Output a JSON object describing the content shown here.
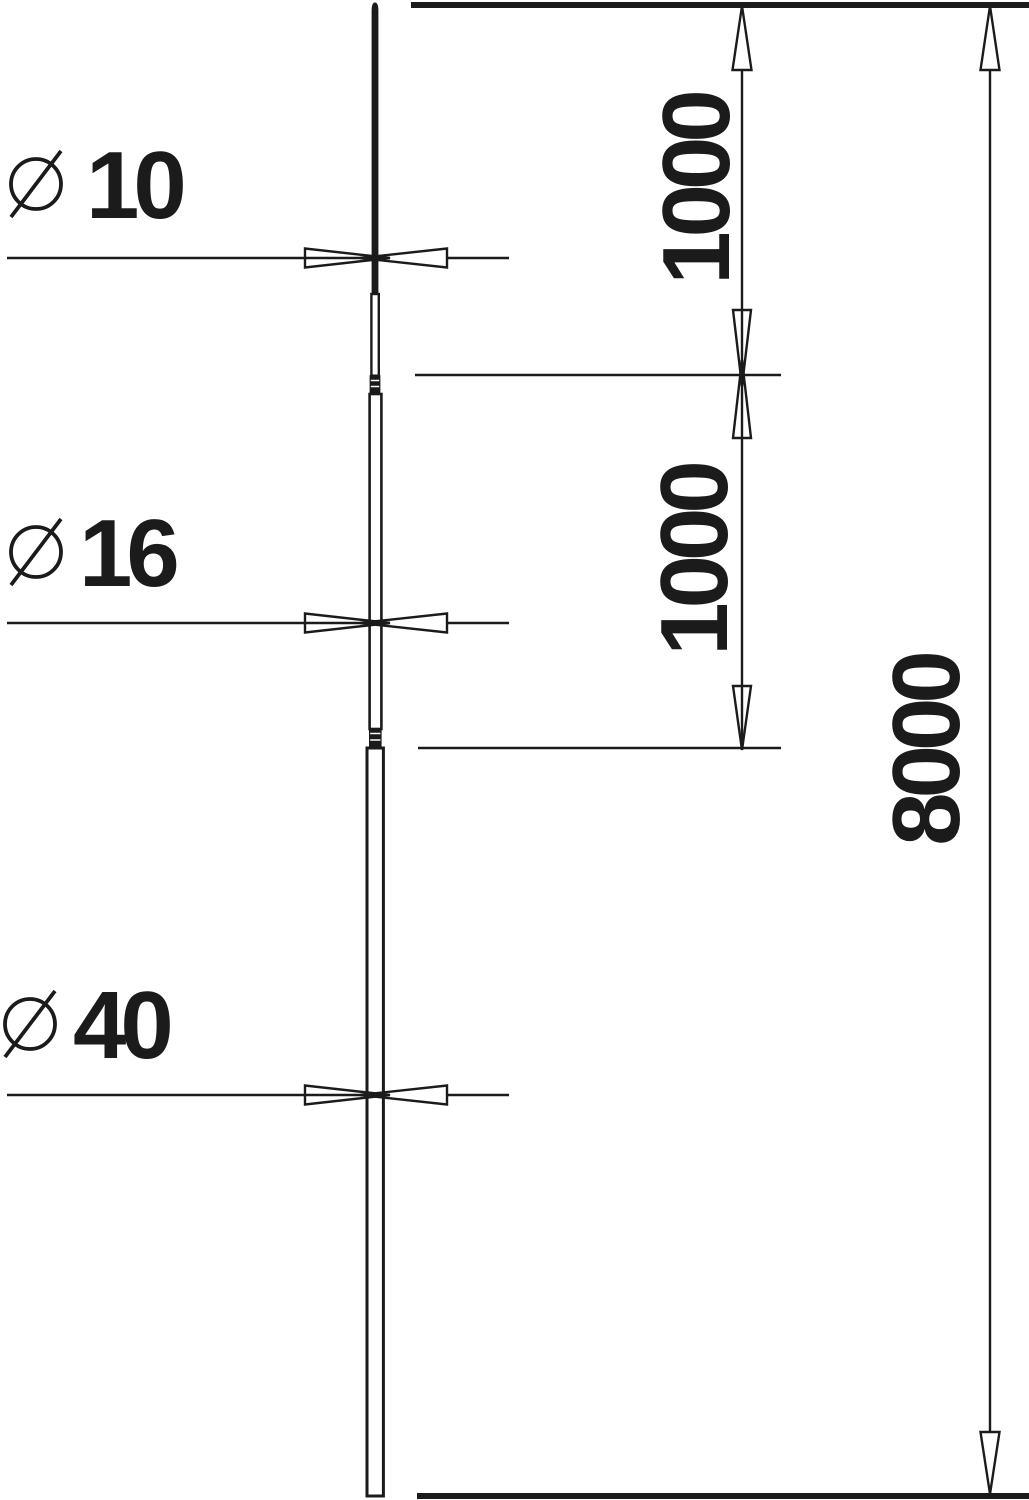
{
  "drawing": {
    "description": "Dimensioned outline drawing of a sectional air-termination rod",
    "background_color": "#ffffff",
    "line_color": "#1b1b1b",
    "diameter_symbol": "⌀",
    "rod_sections": [
      {
        "name": "top-rod",
        "diameter": "10",
        "segment_length": "1000"
      },
      {
        "name": "middle-rod",
        "diameter": "16",
        "segment_length": "1000"
      },
      {
        "name": "base-tube",
        "diameter": "40"
      }
    ],
    "total_length": "8000"
  },
  "labels": {
    "dia_top": "10",
    "dia_mid": "16",
    "dia_base": "40",
    "len_top": "1000",
    "len_mid": "1000",
    "len_total": "8000"
  }
}
